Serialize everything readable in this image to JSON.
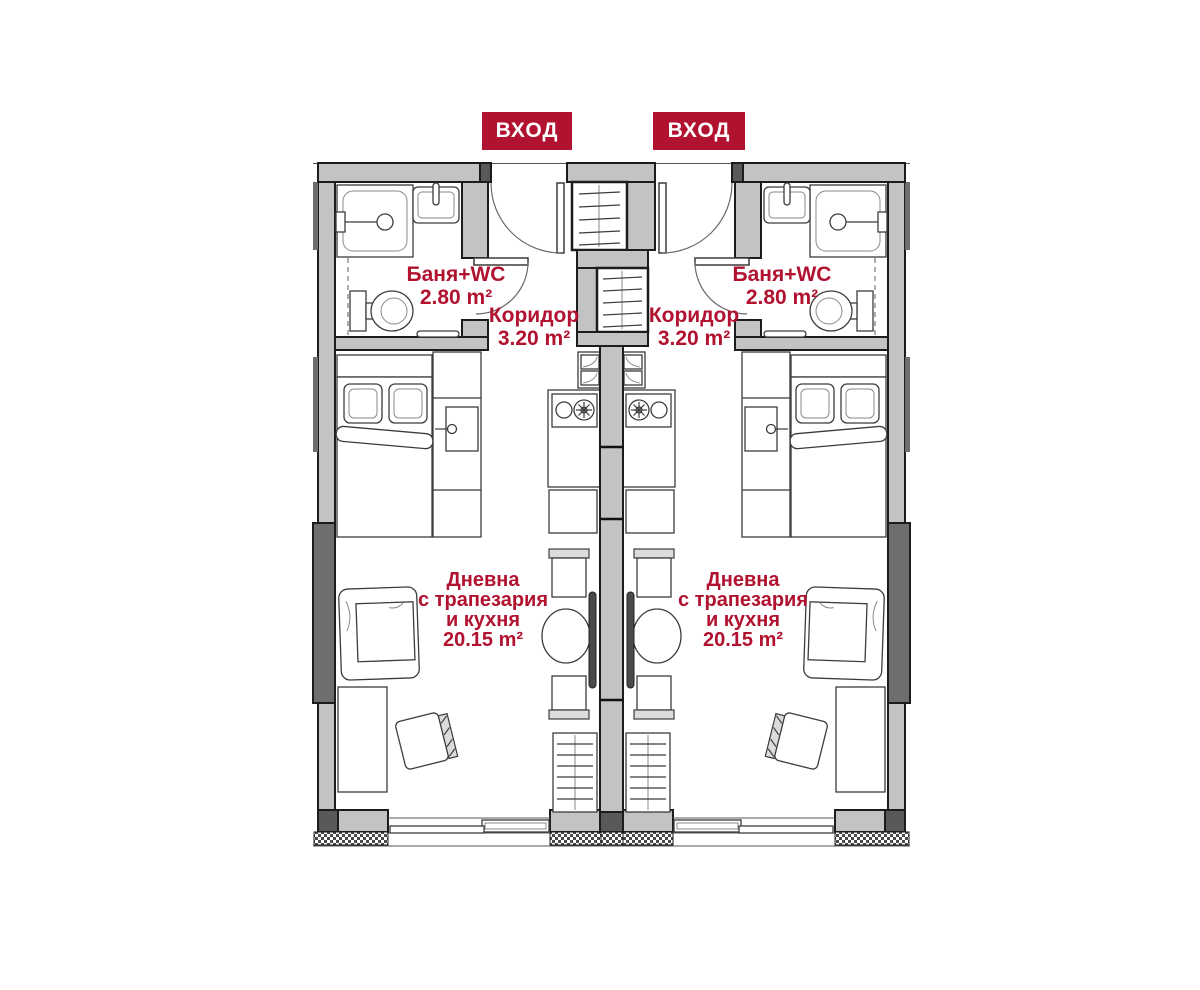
{
  "palette": {
    "accent_red": "#b1122f",
    "wall_light_gray": "#c3c3c3",
    "wall_dark_gray": "#6e6e6e",
    "wall_darker_gray": "#595959",
    "outline": "#1c1c1c"
  },
  "entrance_badges": [
    {
      "label": "ВХОД"
    },
    {
      "label": "ВХОД"
    }
  ],
  "apartments": [
    {
      "side": "left",
      "bathroom": {
        "name": "Баня+WC",
        "area": "2.80 m²"
      },
      "corridor": {
        "name": "Коридор",
        "area": "3.20 m²"
      },
      "living": {
        "name_lines": [
          "Дневна",
          "с трапезария",
          "и кухня"
        ],
        "area": "20.15 m²"
      }
    },
    {
      "side": "right",
      "bathroom": {
        "name": "Баня+WC",
        "area": "2.80 m²"
      },
      "corridor": {
        "name": "Коридор",
        "area": "3.20 m²"
      },
      "living": {
        "name_lines": [
          "Дневна",
          "с трапезария",
          "и кухня"
        ],
        "area": "20.15 m²"
      }
    }
  ]
}
